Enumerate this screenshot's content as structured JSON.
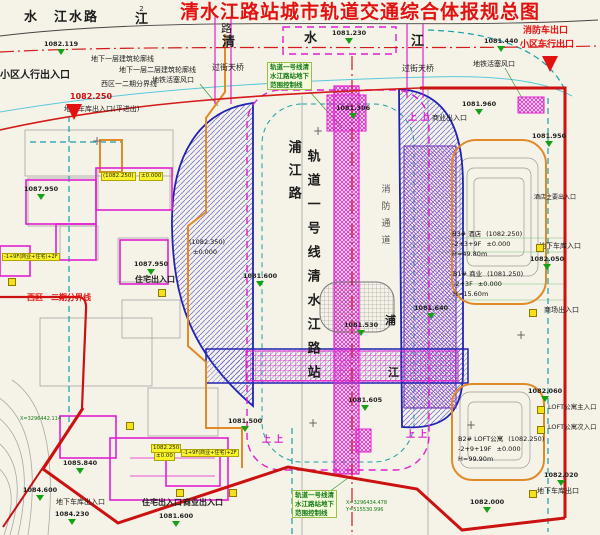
{
  "title": "清水江路站城市轨道交通综合体报规总图",
  "roads": {
    "top_left": "水　江水路",
    "char_lu": "路",
    "char_qing": "清",
    "char_shui": "水",
    "char_jiang": "江",
    "jiang2_sup": "2",
    "jiang2_char": "江",
    "pujiang_vertical": "浦江路",
    "pu": "浦",
    "jiang": "江"
  },
  "station": {
    "line_name_vertical": "轨道一号线清水江路站",
    "fire_lane_vertical": "消防通道"
  },
  "control_lines": {
    "rail_control": [
      "轨道一号线清",
      "水江路站地下",
      "范围控制线"
    ],
    "b1_outline": "地下一层建筑轮廓线",
    "b1b2_outline": "地下一层二层建筑轮廓线",
    "phase_boundary": "西区一二期分界线",
    "piston_vent": "地铁活塞风口"
  },
  "entrances": {
    "residential_ped": "小区人行出入口",
    "fire_exit": "消防车出口",
    "residential_vehicle_exit": "小区车行出口",
    "garage_entrance_flat": "地下车库出入口(平进出)",
    "footbridge": "过街天桥",
    "residential_entrance": "住宅出入口",
    "commercial_entrance": "商业出入口",
    "garage_entrance": "地下车库入口",
    "mall_entrance": "商场出入口",
    "hotel_main": "酒店主要出入口",
    "loft_main": "LOFT公寓主入口",
    "loft_secondary": "LOFT公寓次入口",
    "garage_exit": "地下车库出口",
    "garage_entrance_bl": "地下车库出入口"
  },
  "buildings": {
    "b3": {
      "name": "B3# 酒店",
      "level": "(1082.250)",
      "floors": "-2+3+9F",
      "zero": "±0.000",
      "height": "H=49.80m"
    },
    "b1": {
      "name": "B1# 商业",
      "level": "(1081.250)",
      "floors": "-2+3F",
      "zero": "±0.000",
      "height": "H=15.60m"
    },
    "b2": {
      "name": "B2# LOFT公寓",
      "level": "(1082.250)",
      "floors": "-2+9+19F",
      "zero": "±0.000",
      "height": "H=99.90m"
    },
    "west_level": "(1082.350)",
    "west_zero": "±0.000",
    "tag_a": "(1082.250)",
    "tag_a2": "±0.000",
    "tag_b": "1082.250",
    "tag_b2": "±0.00",
    "tag_mix": "-1+9F(商业+住宅)+2F"
  },
  "elevations": [
    "1082.119",
    "1082.250",
    "1081.230",
    "1081.440",
    "1081.306",
    "1081.960",
    "1081.950",
    "1082.050",
    "1087.950",
    "1087.950",
    "1081.530",
    "1081.605",
    "1081.640",
    "1081.600",
    "1081.500",
    "1082.060",
    "1082.020",
    "1082.000",
    "1081.600",
    "1084.600",
    "1084.230",
    "1085.840"
  ],
  "coordinates": [
    "X=3296434.478",
    "Y=515530.996",
    "X=3296442.114"
  ],
  "symbols": {
    "up": "上 上",
    "cross": "+"
  },
  "colors": {
    "title_red": "#e60012",
    "boundary_red": "#cc1111",
    "magenta": "#e020d0",
    "navy": "#2222b2",
    "teal": "#18a0a8",
    "green": "#157a15",
    "orange": "#e08a28",
    "highlight_yellow": "#f9f42a",
    "paper": "#f5f2e7"
  }
}
